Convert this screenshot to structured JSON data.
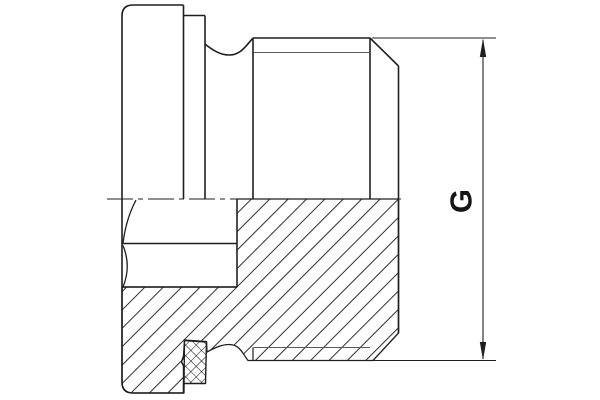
{
  "drawing": {
    "type": "technical-half-section-drawing",
    "part": "screw-plug-with-collar-and-seal",
    "dimension_label": "G",
    "colors": {
      "background": "#ffffff",
      "outline": "#1f1f1f",
      "thin_line": "#5a5a5a",
      "hatch": "#2e2e2e"
    }
  }
}
